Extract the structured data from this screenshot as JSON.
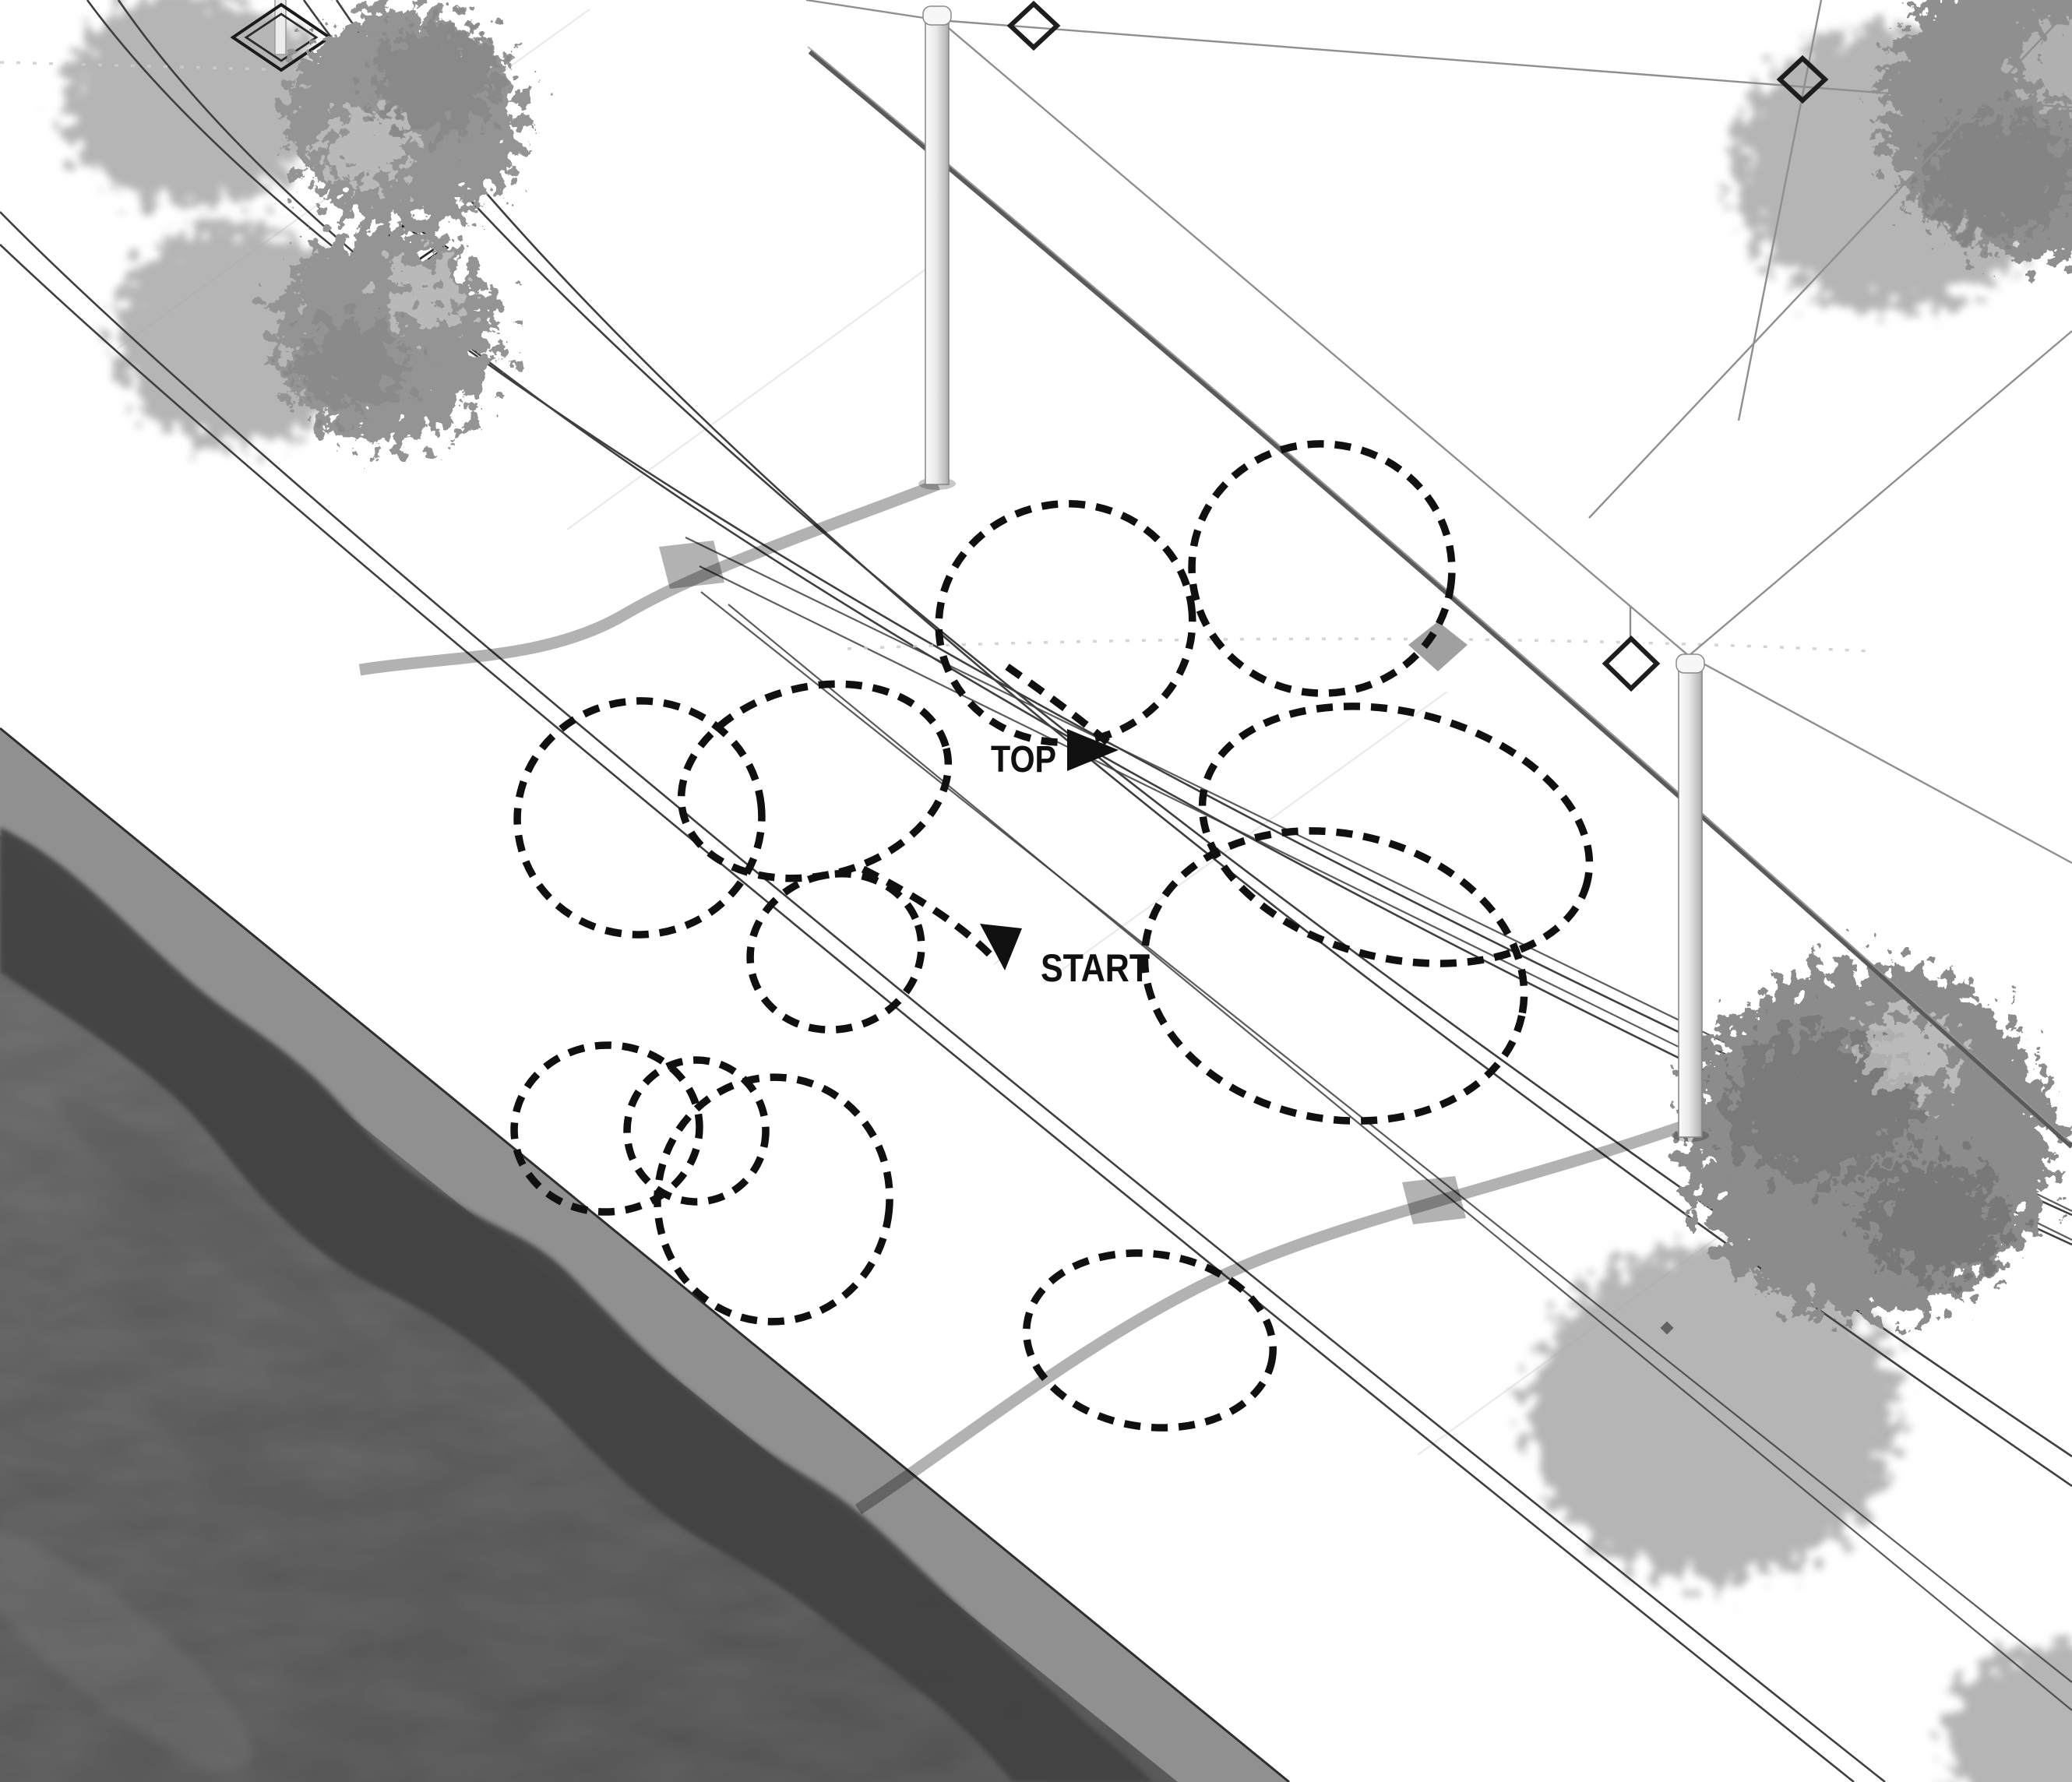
{
  "diagram": {
    "title": "Axonometric street scene with dashed looping movement path",
    "labels": {
      "path_end": "TOP",
      "path_start": "START"
    },
    "annotation_path": {
      "style": "dashed",
      "loop_count": 11,
      "start_marker": "solid-triangle-down",
      "end_marker": "solid-triangle-right"
    },
    "scene_elements": {
      "water": "canal-water",
      "quay": "quay-band",
      "street": "tram-street-lines",
      "poles": 2,
      "catenary_diamonds": 3,
      "trees": 4,
      "tree_planters": 3
    },
    "colors": {
      "ink": "#101010",
      "water_base": "#6c6c6c",
      "water_light": "#7b7b7b",
      "water_deep": "#616161",
      "shore_shadow": "#434343",
      "quay": "#909090",
      "edge_line": "#2e2e2e",
      "line": "#3f3f3f",
      "faint_line": "#dedede",
      "wire": "#8f8f8f",
      "cable": "#5a5a5a",
      "tree_shadow": "#a3a3a3",
      "leaf": "#949494",
      "leaf_dark": "#777777",
      "diamond": "#1d1d1d"
    }
  }
}
